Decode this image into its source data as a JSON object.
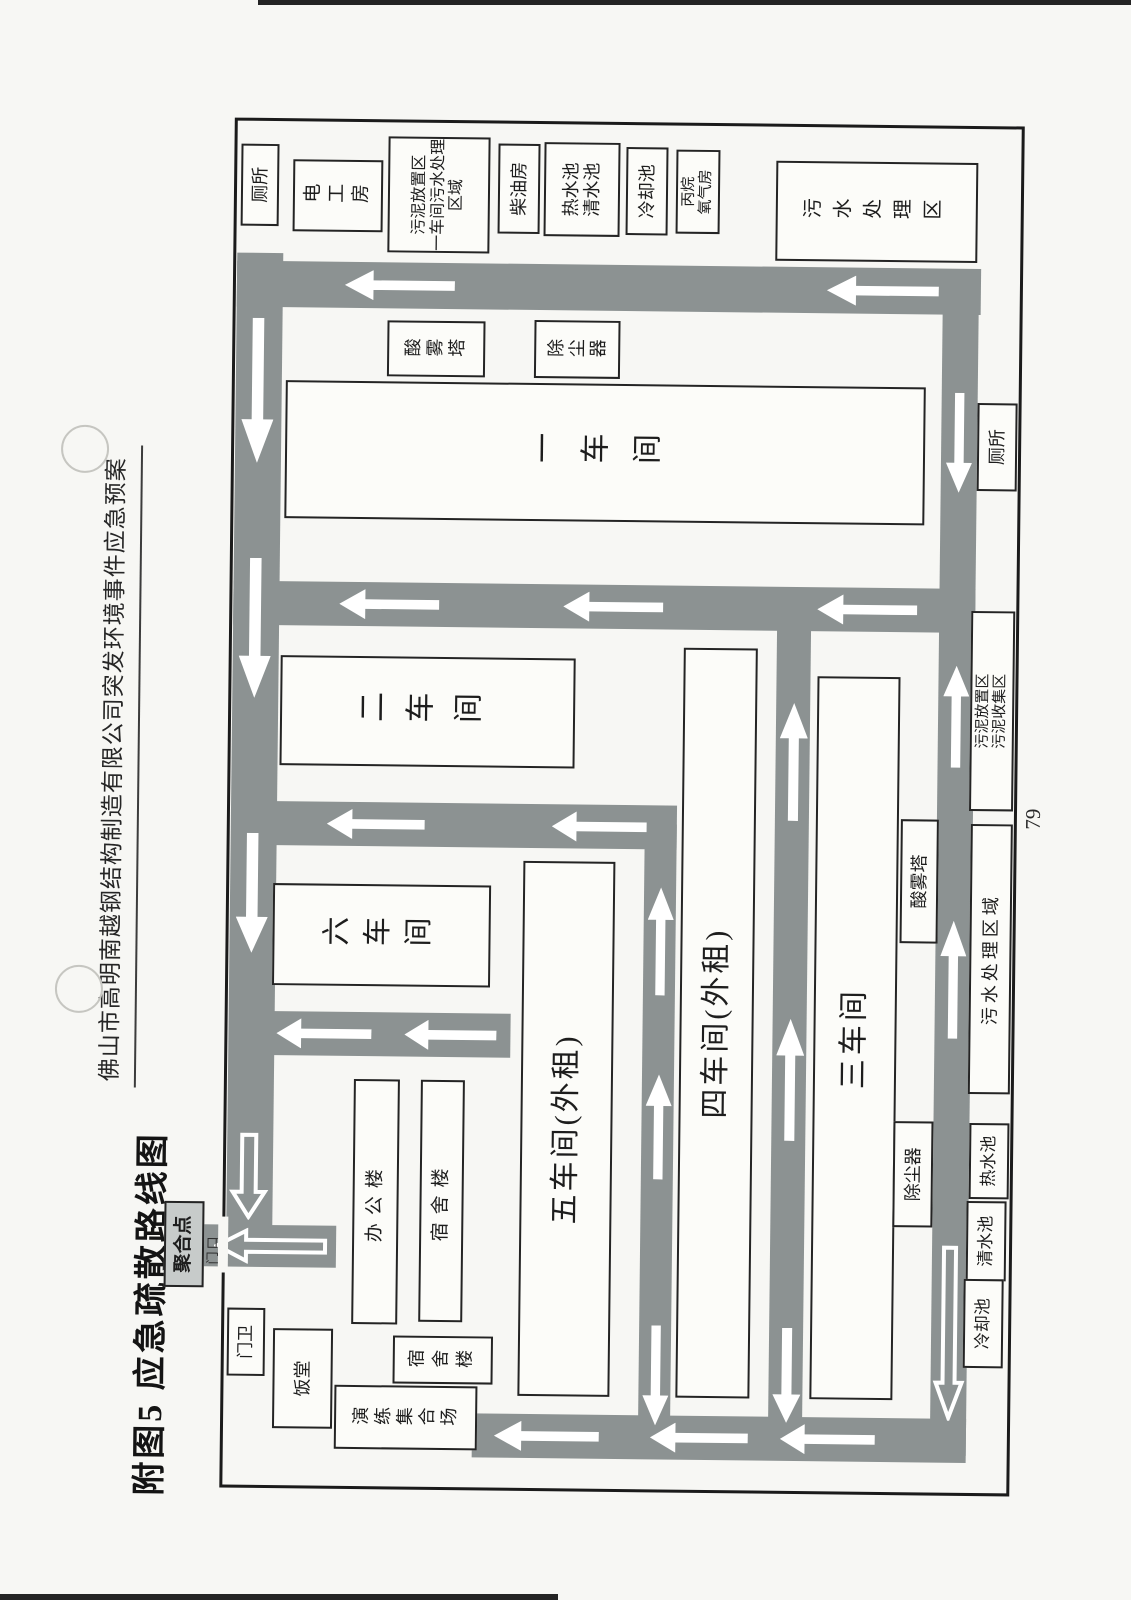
{
  "page": {
    "header": "佛山市高明南越钢结构制造有限公司突发环境事件应急预案",
    "figure_title": "附图5  应急疏散路线图",
    "page_number": "79"
  },
  "colors": {
    "road_gray": "#8c9292",
    "paper": "#f7f7f4",
    "assembly_fill": "#c7cbca",
    "line_black": "#1b1b1b",
    "arrow_white": "#ffffff"
  },
  "map": {
    "assembly_point": "聚合点",
    "gate": "门口",
    "guard": "门卫",
    "canteen": "饭堂",
    "drill_ground": "演练集合场",
    "dorm_small": "宿舍楼",
    "office": "办公楼",
    "dorm_large": "宿舍楼",
    "workshop1": "一车间",
    "workshop2": "二车间",
    "workshop3": "三车间",
    "workshop4": "四车间(外租)",
    "workshop5": "五车间(外租)",
    "workshop6": "六车间",
    "acid_tower_north": "酸雾塔",
    "dust_remover_north": "除尘器",
    "acid_tower_south": "酸雾塔",
    "dust_remover_south": "除尘器",
    "toilet_north": "厕所",
    "electrician_room": "电工房",
    "sludge_north_line1": "污泥放置区",
    "sludge_north_line2": "一车间污水处理区域",
    "diesel_room": "柴油房",
    "hot_pool_east": "热水池",
    "clean_pool_east": "清水池",
    "cooling_pool_east": "冷却池",
    "propane_line1": "丙烷",
    "propane_line2": "氧气房",
    "sewage_area_east": "污水处理区",
    "toilet_south": "厕所",
    "sludge_south_line1": "污泥放置区",
    "sludge_south_line2": "污泥收集区",
    "sewage_area_south": "污水处理区域",
    "hot_pool_south": "热水池",
    "clean_pool_south": "清水池",
    "cooling_pool_south": "冷却池"
  }
}
